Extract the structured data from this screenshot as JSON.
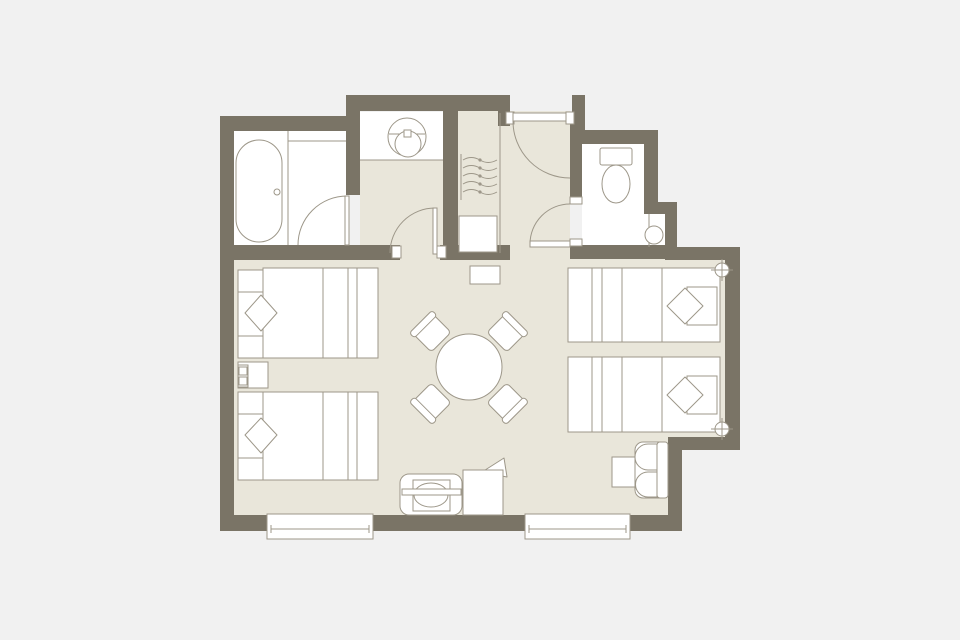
{
  "plan": {
    "kind": "floor-plan",
    "subject": "hotel-guest-room",
    "rooms": [
      {
        "name": "bathroom-with-tub"
      },
      {
        "name": "vanity-room"
      },
      {
        "name": "closet"
      },
      {
        "name": "entry-hall"
      },
      {
        "name": "toilet-room"
      },
      {
        "name": "bedroom"
      }
    ],
    "fixtures": [
      {
        "item": "bathtub",
        "count": 1
      },
      {
        "item": "vanity-sink",
        "count": 1
      },
      {
        "item": "coat-hanger",
        "count": 5
      },
      {
        "item": "storage-box",
        "count": 1
      },
      {
        "item": "toilet",
        "count": 1
      },
      {
        "item": "hand-basin",
        "count": 1
      }
    ],
    "furniture": [
      {
        "item": "double-bed",
        "count": 2
      },
      {
        "item": "twin-bed",
        "count": 2
      },
      {
        "item": "pillow",
        "count": 4
      },
      {
        "item": "nightstand",
        "count": 1
      },
      {
        "item": "telephone",
        "count": 1
      },
      {
        "item": "round-table",
        "count": 1
      },
      {
        "item": "dining-chair",
        "count": 4
      },
      {
        "item": "armchair",
        "count": 1
      },
      {
        "item": "side-table",
        "count": 1
      },
      {
        "item": "luggage-bench",
        "count": 1
      },
      {
        "item": "chair-with-throw",
        "count": 1
      },
      {
        "item": "shoe-cabinet",
        "count": 1
      }
    ],
    "openings": [
      {
        "item": "entry-door",
        "count": 1
      },
      {
        "item": "bathroom-door",
        "count": 1
      },
      {
        "item": "vanity-door",
        "count": 1
      },
      {
        "item": "toilet-room-door",
        "count": 1
      },
      {
        "item": "window",
        "count": 2
      }
    ],
    "symbols": [
      {
        "item": "sprinkler-symbol",
        "count": 2
      }
    ]
  },
  "colors": {
    "background": "#f1f1f1",
    "wall": "#7a7466",
    "floor": "#e9e6da",
    "fixture": "#ffffff",
    "line": "#9d9789"
  }
}
